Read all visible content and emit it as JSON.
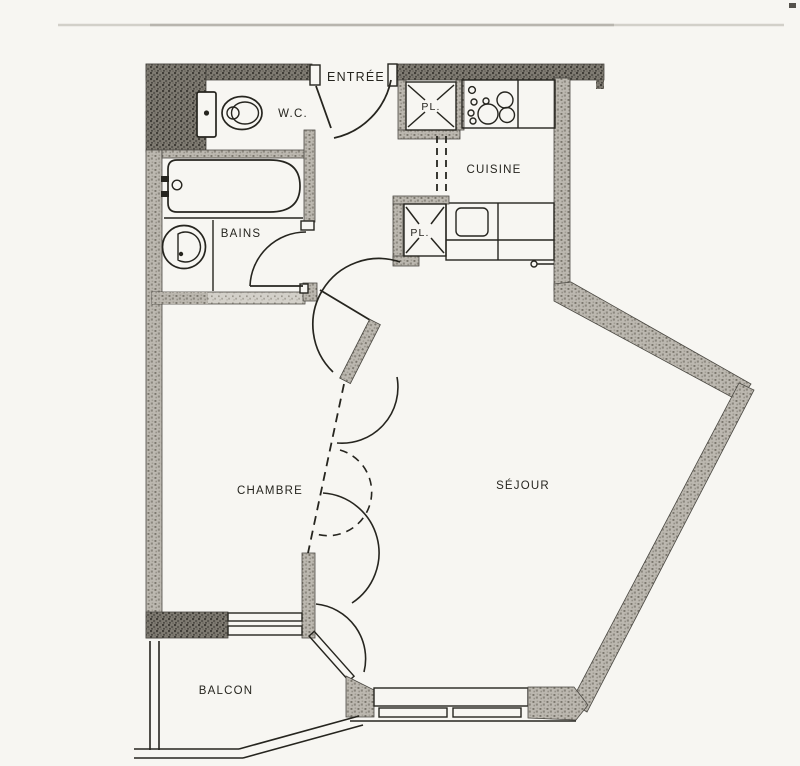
{
  "plan": {
    "rooms": {
      "entree": {
        "label": "ENTRÉE"
      },
      "wc": {
        "label": "W.C."
      },
      "bains": {
        "label": "BAINS"
      },
      "cuisine": {
        "label": "CUISINE"
      },
      "placard_haut": {
        "label": "PL."
      },
      "placard_bas": {
        "label": "PL."
      },
      "chambre": {
        "label": "CHAMBRE"
      },
      "sejour": {
        "label": "SÉJOUR"
      },
      "balcon": {
        "label": "BALCON"
      }
    },
    "fixtures": [
      "toilet",
      "bathtub",
      "washbasin",
      "cooktop-burners",
      "kitchen-sink",
      "closet-cross",
      "door-swing-arc",
      "folding-partition-dashed",
      "balcony-railing",
      "window-glazing"
    ],
    "colors": {
      "paper": "#f7f6f2",
      "ink": "#26251f",
      "wall_dark": "#757168",
      "wall_mid": "#b4b1a9",
      "wall_light": "#cdcac3",
      "faint_line": "#c9c7c0"
    }
  }
}
